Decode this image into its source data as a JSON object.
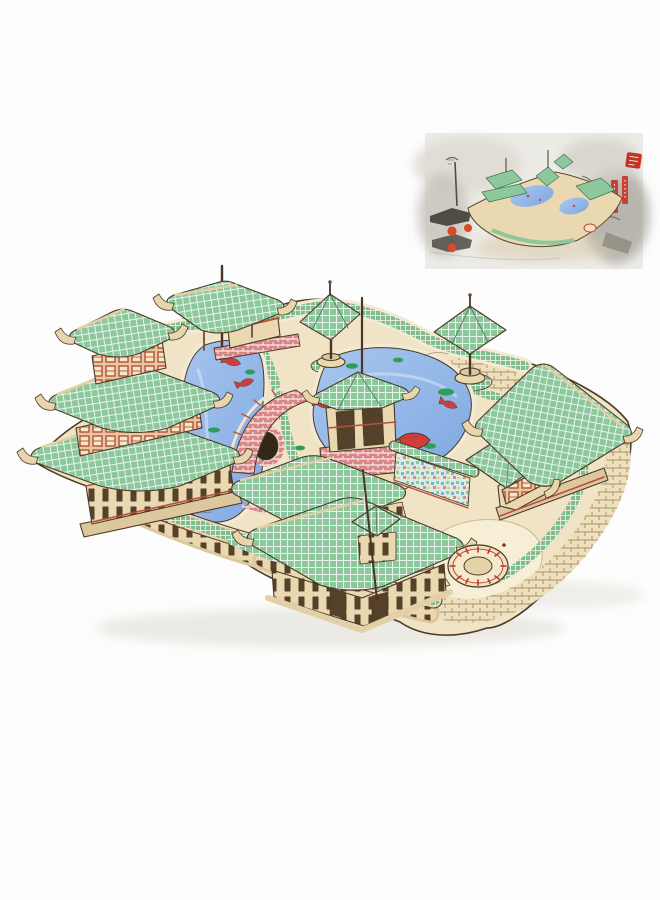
{
  "scene": {
    "kind": "product photo",
    "subject": "3D wooden puzzle model of a classical Chinese garden with koi ponds",
    "inset": "ink-wash style illustration of the assembled model in an old street scene",
    "objects": [
      "three-tier tower pavilion",
      "gate pavilion with tall mast",
      "two parasol pavilions on poles",
      "hexagonal lake pavilion with brick base",
      "main hall with rooftop cupola",
      "east hall with hip roof",
      "covered corridor gallery",
      "arched brick bridge",
      "two blue koi ponds with lily pads",
      "circular well plaza",
      "checkered garden walkways and brick paths"
    ]
  },
  "palette": {
    "page_bg": "#fdfdfd",
    "photo_shadow": "#d8d2c6",
    "outline": "#4a3a26",
    "base_board": "#f1e3c6",
    "base_edge": "#dcc79e",
    "lawn": "#f7eed6",
    "roof_green": "#8cc89c",
    "walk_green": "#7dbd8e",
    "brick_cream": "#efe0bd",
    "brick_line": "#a89468",
    "brick_pink": "#d88585",
    "wall_cream": "#ead8b0",
    "wood_dark": "#6b5236",
    "slot_dark": "#55402a",
    "trim_red": "#b5503c",
    "window_bg": "#f6e7c8",
    "water_light": "#a8c6ee",
    "water_deep": "#7fa9e2",
    "shore": "#f3ead6",
    "koi_red": "#d23c3c",
    "koi_orange": "#e06a38",
    "lily_green": "#2f9e54",
    "mural_bg": "#d8ece4",
    "inset_bg": "#ecebe6",
    "ink_dark": "#4f4c46",
    "mist_gray": "#c2beb5",
    "stone_gray": "#8d897f",
    "lantern_red": "#d84a28",
    "seal_red": "#c23326",
    "banner_red": "#cc4034"
  }
}
